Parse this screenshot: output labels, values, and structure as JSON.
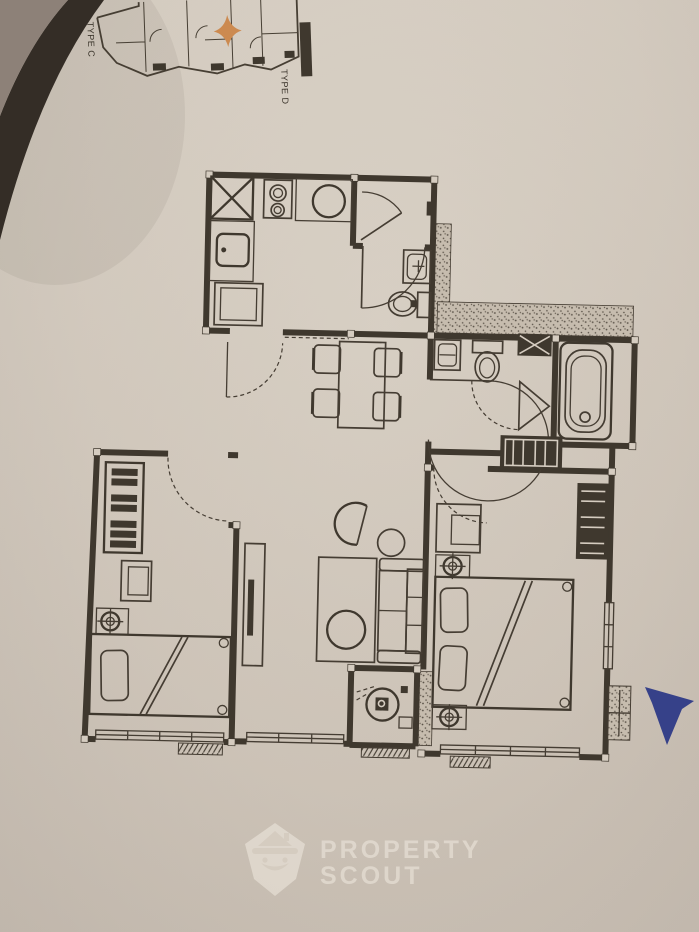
{
  "photo": {
    "paper_color": "#d5ccc0",
    "line_color": "#3f382e",
    "corner_taupe_color": "#8d8178",
    "corner_dark_color": "#342d26"
  },
  "key_plan": {
    "label_left": "TYPE C",
    "label_right": "TYPE D",
    "highlight_color": "#cc8a50"
  },
  "marker": {
    "color": "#2e3a87"
  },
  "watermark": {
    "line1": "PROPERTY",
    "line2": "SCOUT",
    "color": "rgba(243,237,227,0.5)"
  }
}
